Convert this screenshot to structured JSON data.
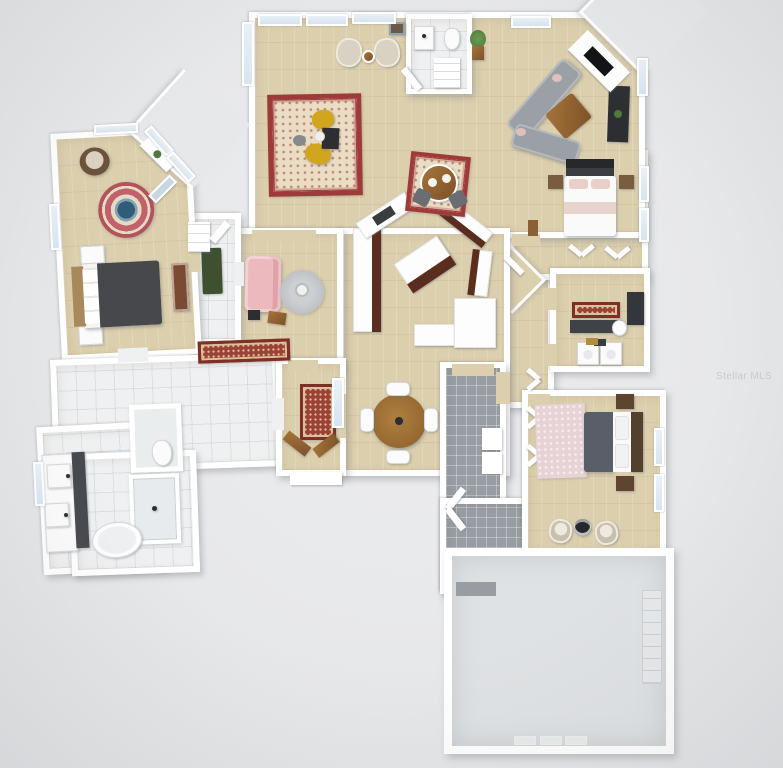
{
  "scene": {
    "type": "3d-floor-plan-render",
    "view": "top-down dollhouse view, virtually staged single-story home with attached garage",
    "watermark": "Stellar MLS"
  },
  "colors": {
    "bg": "#e7e8ea",
    "wall": "#ffffff",
    "wood": "#dccfad",
    "tile": "#eef0f1",
    "grayTile": "#979da3",
    "garage": "#dfe2e4",
    "rugRed": "#9e3a38",
    "rugCream": "#e9ddc4",
    "runnerRust": "#9c4136",
    "accentYellow": "#d2a51e",
    "sofaGray": "#9aa0a5",
    "sofaPink": "#ecb9be",
    "bedDark": "#46484c",
    "bedDark2": "#585f69",
    "woodFurn": "#9a6b35",
    "cabinetCherry": "#5a2d1f",
    "darkFixture": "#2c2e31",
    "windowGlass": "#d7e4ef",
    "plantGreen": "#4e7a3a",
    "matGreen": "#3f5030",
    "rugPink": "#e7d2d5",
    "rugTeal": "#2f5d79"
  },
  "rooms": [
    {
      "name": "formal-sitting-room",
      "floor": "wood",
      "furniture": [
        "oriental area rug",
        "two mustard accent chairs",
        "black side table",
        "gray pouf",
        "two cream armchairs",
        "round side table",
        "wall art",
        "potted plant"
      ]
    },
    {
      "name": "powder-room",
      "floor": "tile",
      "furniture": [
        "vanity sink",
        "toilet",
        "ladder shelf"
      ]
    },
    {
      "name": "family-room",
      "floor": "wood",
      "furniture": [
        "gray L-sectional with blush pillows",
        "wood coffee table",
        "corner fireplace with TV",
        "black media console with plant"
      ]
    },
    {
      "name": "kitchen",
      "floor": "wood",
      "furniture": [
        "angled cherry cabinets with white counters",
        "sink",
        "center island",
        "wrap-around breakfast bar"
      ]
    },
    {
      "name": "breakfast-nook",
      "floor": "wood",
      "furniture": [
        "small oriental rug",
        "round wood table with two place settings",
        "two dark chairs"
      ]
    },
    {
      "name": "dining-area",
      "floor": "wood",
      "furniture": [
        "round wood table",
        "four white chairs"
      ]
    },
    {
      "name": "den-sitting-area",
      "floor": "wood",
      "furniture": [
        "pink loveseat",
        "round gray rug",
        "round side table",
        "two small accent tables",
        "oriental runner"
      ]
    },
    {
      "name": "primary-bedroom",
      "floor": "wood",
      "furniture": [
        "bed with dark gray duvet",
        "two nightstands",
        "brown papasan chair",
        "round pink-and-teal rug",
        "corner desk with plant",
        "leaning mirror",
        "wood armoire"
      ]
    },
    {
      "name": "hall-bath-vestibule",
      "floor": "tile",
      "furniture": [
        "green bath mat",
        "white shelf"
      ]
    },
    {
      "name": "primary-bathroom",
      "floor": "tile",
      "furniture": [
        "double vanity with dark counter",
        "freestanding oval tub",
        "glass shower",
        "water closet with toilet"
      ]
    },
    {
      "name": "entry-foyer",
      "floor": "wood",
      "furniture": [
        "rust oriental runner",
        "two angled wood benches",
        "front door step"
      ]
    },
    {
      "name": "bedroom-2",
      "floor": "wood",
      "furniture": [
        "bed with dark accent wall and blush pillows",
        "two wood nightstands",
        "bifold closet doors"
      ]
    },
    {
      "name": "bathroom-2",
      "floor": "wood",
      "furniture": [
        "red runner",
        "dark vanity",
        "toilet",
        "dark shower"
      ]
    },
    {
      "name": "laundry-room",
      "floor": "wood",
      "furniture": [
        "washer",
        "dryer",
        "laundry items"
      ]
    },
    {
      "name": "mudroom-hall",
      "floor": "gray-tile",
      "furniture": [
        "white storage cabinets",
        "closet doors"
      ]
    },
    {
      "name": "bedroom-3",
      "floor": "wood",
      "furniture": [
        "bed with gray duvet and brown headboard",
        "two brown nightstands",
        "pink rug",
        "two cream bucket chairs",
        "round black side table"
      ]
    },
    {
      "name": "garage",
      "floor": "concrete",
      "furniture": [
        "wall storage shelves",
        "floor thresholds"
      ]
    }
  ]
}
